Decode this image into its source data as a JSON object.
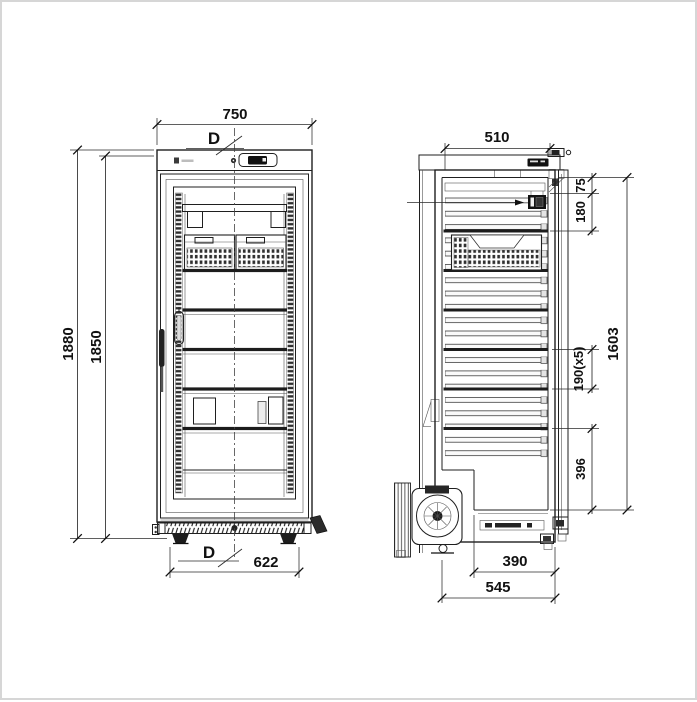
{
  "drawing": {
    "title": "refrigerator-dimension-drawing",
    "colors": {
      "line": "#1f1f1f",
      "background": "#ffffff",
      "border": "#d6d6d6"
    },
    "icons": [
      "brand-logo",
      "control-display",
      "door-handle",
      "compressor-fan",
      "hinge"
    ],
    "front_view": {
      "dims": {
        "width": "750",
        "door_ref_top": "D",
        "height_total": "1880",
        "height_body": "1850",
        "door_ref_bottom": "D",
        "base_width": "622"
      }
    },
    "side_view": {
      "dims": {
        "depth_body": "510",
        "top_gap": "75",
        "evap_zone": "180",
        "shelf_pitch": "190(x5)",
        "interior_height": "1603",
        "bottom_gap": "396",
        "floor_depth": "390",
        "base_depth": "545"
      }
    }
  }
}
